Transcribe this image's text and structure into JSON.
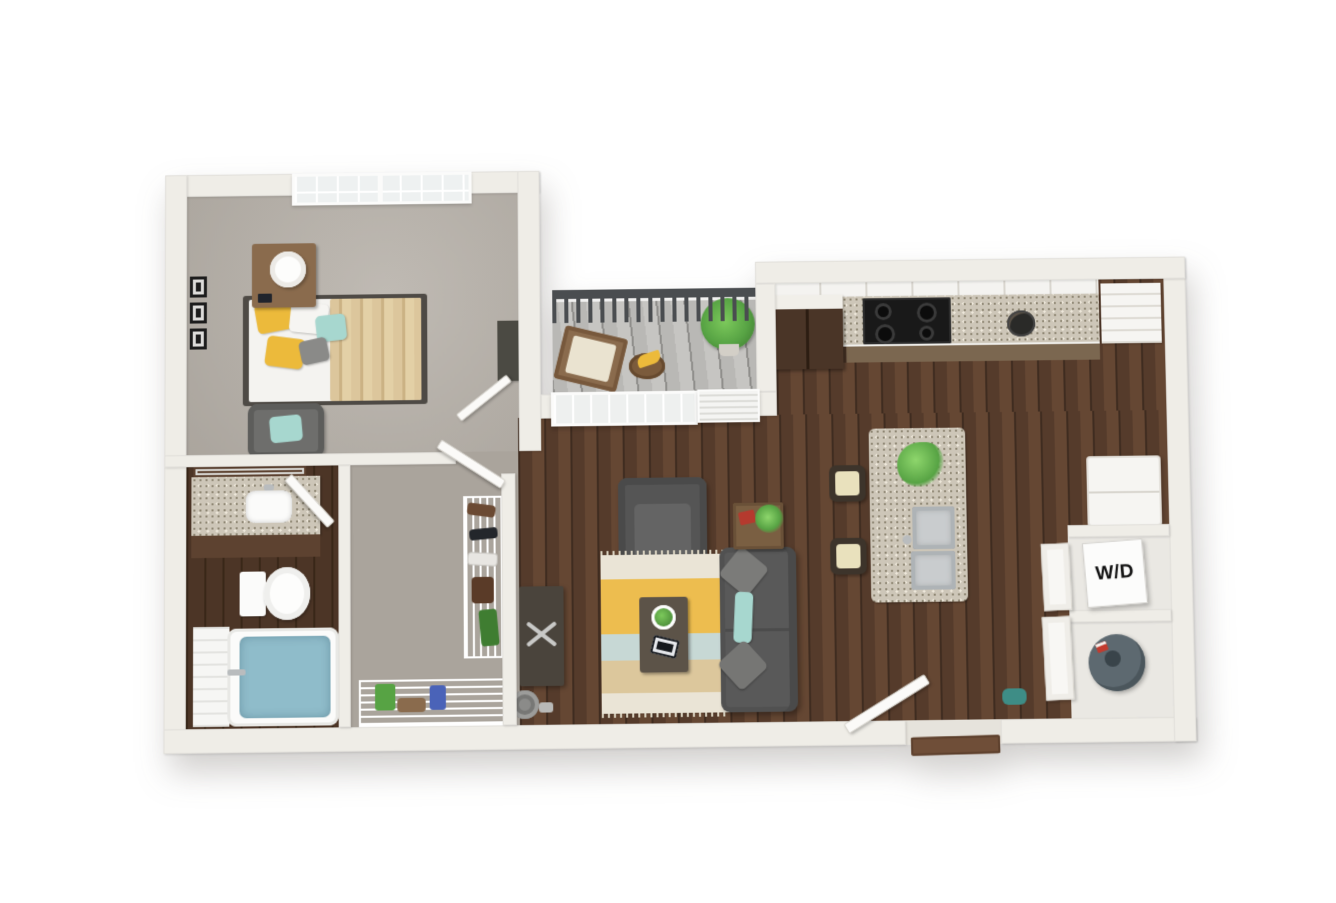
{
  "meta": {
    "type": "3d-floorplan-render",
    "view": "top-down dollhouse",
    "visible_text": [
      "W/D"
    ]
  },
  "labels": {
    "washer_dryer": "W/D"
  },
  "colors": {
    "wall": "#efede7",
    "wallShade": "#dcd8d0",
    "wood": "#553b2b",
    "woodDark": "#3f2c20",
    "woodLight": "#654733",
    "bathWood": "#4c3526",
    "bathWoodDark": "#392718",
    "carpet": "#b5afa7",
    "carpetDark": "#aaa49c",
    "deck": "#b9b8b5",
    "deckDark": "#8f8e8b",
    "railing": "#4a4d50",
    "granite": "#cdc6b8",
    "graniteDot": "#8f8774",
    "cabDark": "#4a3527",
    "cabMed": "#7b6750",
    "vanityWood": "#5d4230",
    "nstand": "#8a6b4d",
    "teal": "#a7d7cf",
    "yellow": "#ecba3b",
    "blanket": "#dcc69c",
    "cream": "#e9e1bd",
    "rugCream": "#eae4d6",
    "rugYellow": "#edbd4f",
    "rugBlue": "#c7d8d5",
    "rugTan": "#dcc79c",
    "tableWood": "#5c5348",
    "console": "#4a443c",
    "water": "#8fbcca",
    "plant": "#57a344",
    "plantDark": "#3f7d31",
    "heater": "#5d6970",
    "mat": "#6f4e38",
    "metal": "#b9bcbe"
  },
  "rooms": [
    {
      "id": "bedroom",
      "items": [
        "queen-bed",
        "tan-striped-blanket",
        "yellow-pillows",
        "teal-pillow",
        "gray-pillow",
        "nightstand",
        "table-lamp",
        "smartphone",
        "wall-frames",
        "accent-chair",
        "dresser",
        "grid-window"
      ]
    },
    {
      "id": "bathroom",
      "items": [
        "granite-vanity",
        "sink",
        "framed-mirror",
        "toilet",
        "bathtub-with-water",
        "tile-surround",
        "chrome-faucet"
      ]
    },
    {
      "id": "walk-in-closet",
      "items": [
        "wire-shelving",
        "shoes",
        "boots",
        "hanging-garment",
        "storage-bins",
        "basket"
      ]
    },
    {
      "id": "balcony",
      "items": [
        "metal-railing",
        "deck-boards",
        "wood-lounge-chair",
        "fruit-basket",
        "potted-plant"
      ]
    },
    {
      "id": "living-room",
      "items": [
        "gray-sofa",
        "gray-armchair",
        "striped-area-rug",
        "coffee-table",
        "houseplant",
        "tablet",
        "side-table",
        "red-book",
        "tv-console",
        "speaker",
        "picture-window",
        "louvered-door"
      ]
    },
    {
      "id": "kitchen",
      "items": [
        "upper-cabinets",
        "granite-counter",
        "black-cooktop-range",
        "dark-pantry-cabinet",
        "lower-cabinets",
        "corner-open-shelves",
        "wire-fruit-bowl",
        "granite-island",
        "double-stainless-sink",
        "bar-stools",
        "refrigerator"
      ]
    },
    {
      "id": "laundry-closet",
      "items": [
        "stacked-washer-dryer-box",
        "water-heater",
        "paneled-double-doors"
      ]
    },
    {
      "id": "entry",
      "items": [
        "open-front-door",
        "door-mat",
        "teal-duffel-bag"
      ]
    }
  ]
}
